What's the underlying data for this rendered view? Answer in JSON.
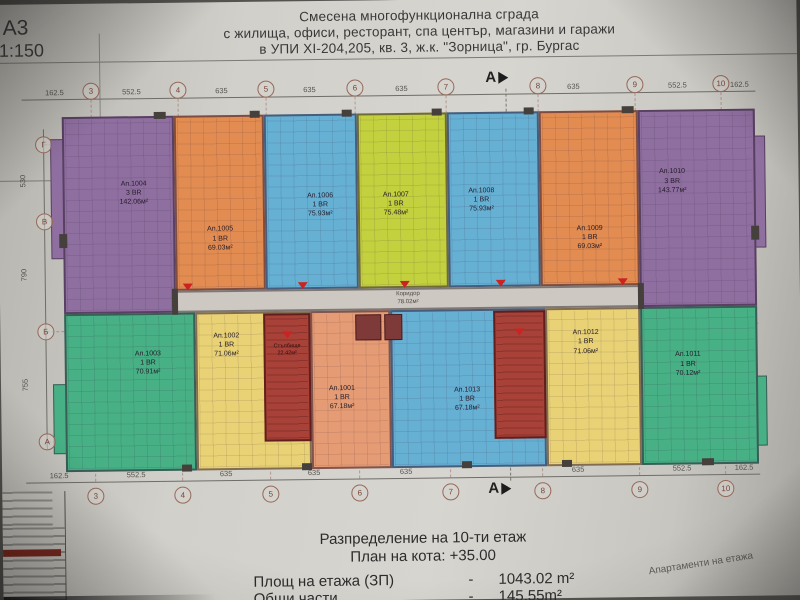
{
  "sheet": {
    "format": "А3",
    "scale": "1:150",
    "title_lines": [
      "Смесена многофункционална сграда",
      "с жилища, офиси, ресторант, спа център, магазини и  гаражи",
      "в УПИ XI-204,205, кв. 3, ж.к. \"Зорница\", гр. Бургас"
    ],
    "section_letter": "А"
  },
  "grid": {
    "top_columns": [
      "3",
      "4",
      "5",
      "6",
      "7",
      "8",
      "9",
      "10"
    ],
    "top_dims": [
      "162.5",
      "552.5",
      "635",
      "635",
      "635",
      "635",
      "635",
      "552.5",
      "162.5"
    ],
    "left_rows": [
      "Г",
      "В",
      "Б",
      "А"
    ],
    "left_dims": [
      "530",
      "790",
      "755"
    ]
  },
  "apartments": [
    {
      "id": "1001",
      "name": "Ап.1001",
      "rooms": "1 BR",
      "area": "67.18м²",
      "color": "#e59c74"
    },
    {
      "id": "1002",
      "name": "Ап.1002",
      "rooms": "1 BR",
      "area": "71.06м²",
      "color": "#e9d276"
    },
    {
      "id": "1003",
      "name": "Ап.1003",
      "rooms": "1 BR",
      "area": "70.91м²",
      "color": "#47b085"
    },
    {
      "id": "1004",
      "name": "Ап.1004",
      "rooms": "3 BR",
      "area": "142.06м²",
      "color": "#8f6fa0"
    },
    {
      "id": "1005",
      "name": "Ап.1005",
      "rooms": "1 BR",
      "area": "69.03м²",
      "color": "#e28c52"
    },
    {
      "id": "1006",
      "name": "Ап.1006",
      "rooms": "1 BR",
      "area": "75.93м²",
      "color": "#66b0d4"
    },
    {
      "id": "1007",
      "name": "Ап.1007",
      "rooms": "1 BR",
      "area": "75.48м²",
      "color": "#c3d13f"
    },
    {
      "id": "1008",
      "name": "Ап.1008",
      "rooms": "1 BR",
      "area": "75.93м²",
      "color": "#66b0d4"
    },
    {
      "id": "1009",
      "name": "Ап.1009",
      "rooms": "1 BR",
      "area": "69.03м²",
      "color": "#e28c52"
    },
    {
      "id": "1010",
      "name": "Ап.1010",
      "rooms": "3 BR",
      "area": "143.77м²",
      "color": "#8f6fa0"
    },
    {
      "id": "1011",
      "name": "Ап.1011",
      "rooms": "1 BR",
      "area": "70.12м²",
      "color": "#47b085"
    },
    {
      "id": "1012",
      "name": "Ап.1012",
      "rooms": "1 BR",
      "area": "71.06м²",
      "color": "#e9d276"
    },
    {
      "id": "1013",
      "name": "Ап.1013",
      "rooms": "1 BR",
      "area": "67.18м²",
      "color": "#66b0d4"
    }
  ],
  "common": {
    "corridor": {
      "label": "Коридор",
      "area": "78.02м²",
      "color": "#cdc9c2"
    },
    "stairwell": {
      "label": "Стълбище",
      "area": "22.42м²",
      "color": "#a84138"
    },
    "maroon_color": "#7e3a38"
  },
  "footer": {
    "heading": "Разпределение на 10-ти етаж",
    "subheading": "План на кота:  +35.00",
    "rows": [
      {
        "label": "Площ на етажа (ЗП)",
        "dash": "-",
        "value": "1043.02 m²"
      },
      {
        "label": "Общи части",
        "dash": "-",
        "value": "145.55m²"
      }
    ],
    "side_note": "Апартаменти на етажа"
  }
}
